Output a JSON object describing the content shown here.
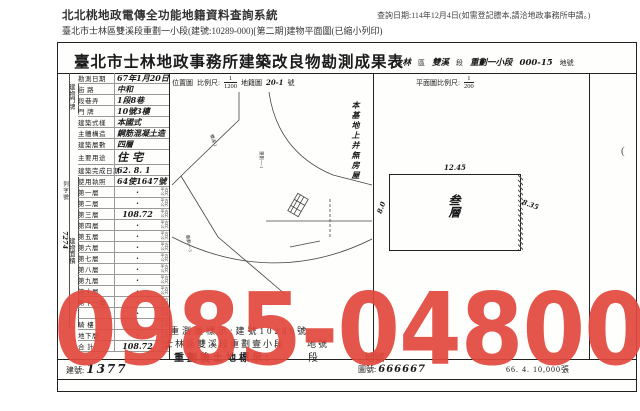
{
  "header": {
    "system_title": "北北桃地政電傳全功能地籍資料查詢系統",
    "query_note": "查詢日期:114年12月4日(如需登記謄本,請洽地政事務所申請。)",
    "subtitle": "臺北市士林區雙溪段重劃一小段(建號:10289-000)[第二期]建物平面圖(已縮小列印)"
  },
  "sheet": {
    "title": "臺北市士林地政事務所建築改良物勘測成果表",
    "title_right": {
      "district_hw": "士林",
      "district": "區",
      "section_hw": "雙溪",
      "section": "段",
      "subsection_hw": "重劃一小段",
      "parcel_hw": "000-15",
      "parcel": "地號"
    }
  },
  "left_table": {
    "outer_label": "列字號",
    "outer_value": "7274",
    "group_addr": "建物門牌",
    "group_area": "建物面積",
    "unit": "平方公尺",
    "rows": [
      {
        "label": "勘測日期",
        "value": "67年1月20日"
      },
      {
        "label": "街 路",
        "value": "中和"
      },
      {
        "label": "段巷弄",
        "value": "1段8巷"
      },
      {
        "label": "門 牌",
        "value": "10號3樓"
      },
      {
        "label": "建築式樣",
        "value": "本國式"
      },
      {
        "label": "主體構造",
        "value": "鋼筋混凝土造"
      },
      {
        "label": "建築層數",
        "value": "四層"
      },
      {
        "label": "主要用途",
        "value": "住宅"
      },
      {
        "label": "建築完成日期",
        "value": "62. 8. 1"
      },
      {
        "label": "使用執照",
        "value": "64使1647號"
      }
    ],
    "floors": [
      {
        "label": "第一層",
        "value": ""
      },
      {
        "label": "第二層",
        "value": ""
      },
      {
        "label": "第三層",
        "value": "108.72"
      },
      {
        "label": "第四層",
        "value": ""
      },
      {
        "label": "第五層",
        "value": ""
      },
      {
        "label": "第六層",
        "value": ""
      },
      {
        "label": "第七層",
        "value": ""
      },
      {
        "label": "第八層",
        "value": ""
      },
      {
        "label": "第九層",
        "value": ""
      },
      {
        "label": "第十層",
        "value": ""
      },
      {
        "label": "第十一層",
        "value": ""
      },
      {
        "label": "",
        "value": ""
      },
      {
        "label": "騎 樓",
        "value": ""
      },
      {
        "label": "地下層",
        "value": ""
      },
      {
        "label": "合 計",
        "value": "108.72"
      }
    ]
  },
  "location_map": {
    "label": "位置圖",
    "scale_label": "比例尺:",
    "scale_num": "1",
    "scale_den": "1200",
    "map_ref": "地籍圖",
    "map_no_hw": "20-1",
    "map_no_suffix": "號",
    "note": "本基地上并無房屋",
    "labels": [
      "雙溪-1",
      "重劃一-1",
      "重劃一-3"
    ]
  },
  "floor_plan": {
    "header_label": "平面圖比例尺:",
    "scale_num": "1",
    "scale_den": "200",
    "room_label": "叁層",
    "dim_top": "12.45",
    "dim_left": "8.0",
    "dim_right": "8.35"
  },
  "bottom": {
    "line1": "重測後標示:建號10289號",
    "line2": "士林區雙溪段重劃壹小段　　地號",
    "line3_bold": "重劃後土地標示:",
    "line3_seg": "段",
    "line3_parcel": "地號"
  },
  "strip": {
    "building_no_label": "建號:",
    "building_no": "1377",
    "map_no_label": "圖號:",
    "map_no": "666667",
    "print_info": "66. 4. 10,000張"
  },
  "artifact": {
    "paren": "("
  },
  "watermark": {
    "text": "0985-048006",
    "color": "#e2483d"
  }
}
